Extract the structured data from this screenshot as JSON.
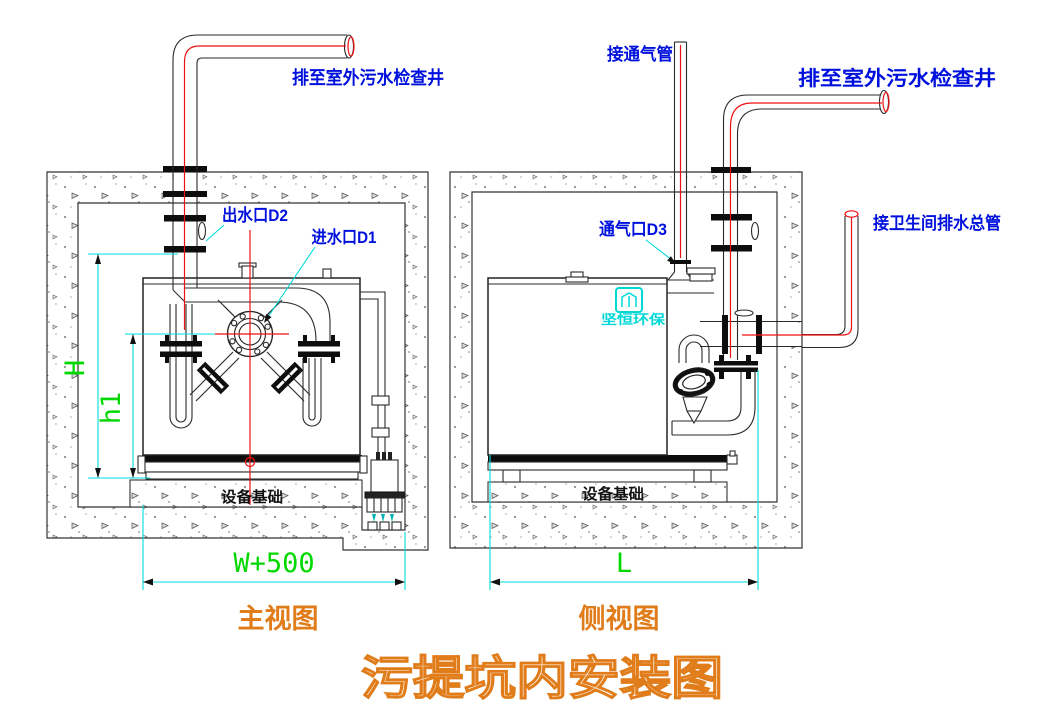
{
  "title": "污提坑内安装图",
  "front_view": {
    "caption": "主视图",
    "labels": {
      "drain_well": "排至室外污水检查井",
      "outlet": "出水口D2",
      "inlet": "进水口D1",
      "foundation": "设备基础"
    },
    "dims": {
      "h": "H",
      "h1": "h1",
      "w": "W+500"
    }
  },
  "side_view": {
    "caption": "侧视图",
    "labels": {
      "vent_pipe": "接通气管",
      "drain_well": "排至室外污水检查井",
      "vent_port": "通气口D3",
      "toilet_main": "接卫生间排水总管",
      "foundation": "设备基础"
    },
    "dims": {
      "l": "L"
    },
    "logo_text": "坚恒环保"
  },
  "colors": {
    "label_blue": "#0010dd",
    "centerline_red": "#ee1111",
    "dimension_cyan": "#00dcdc",
    "dimension_green": "#00d800",
    "caption_orange": "#e07c1a",
    "logo_cyan": "#00d8d8"
  }
}
